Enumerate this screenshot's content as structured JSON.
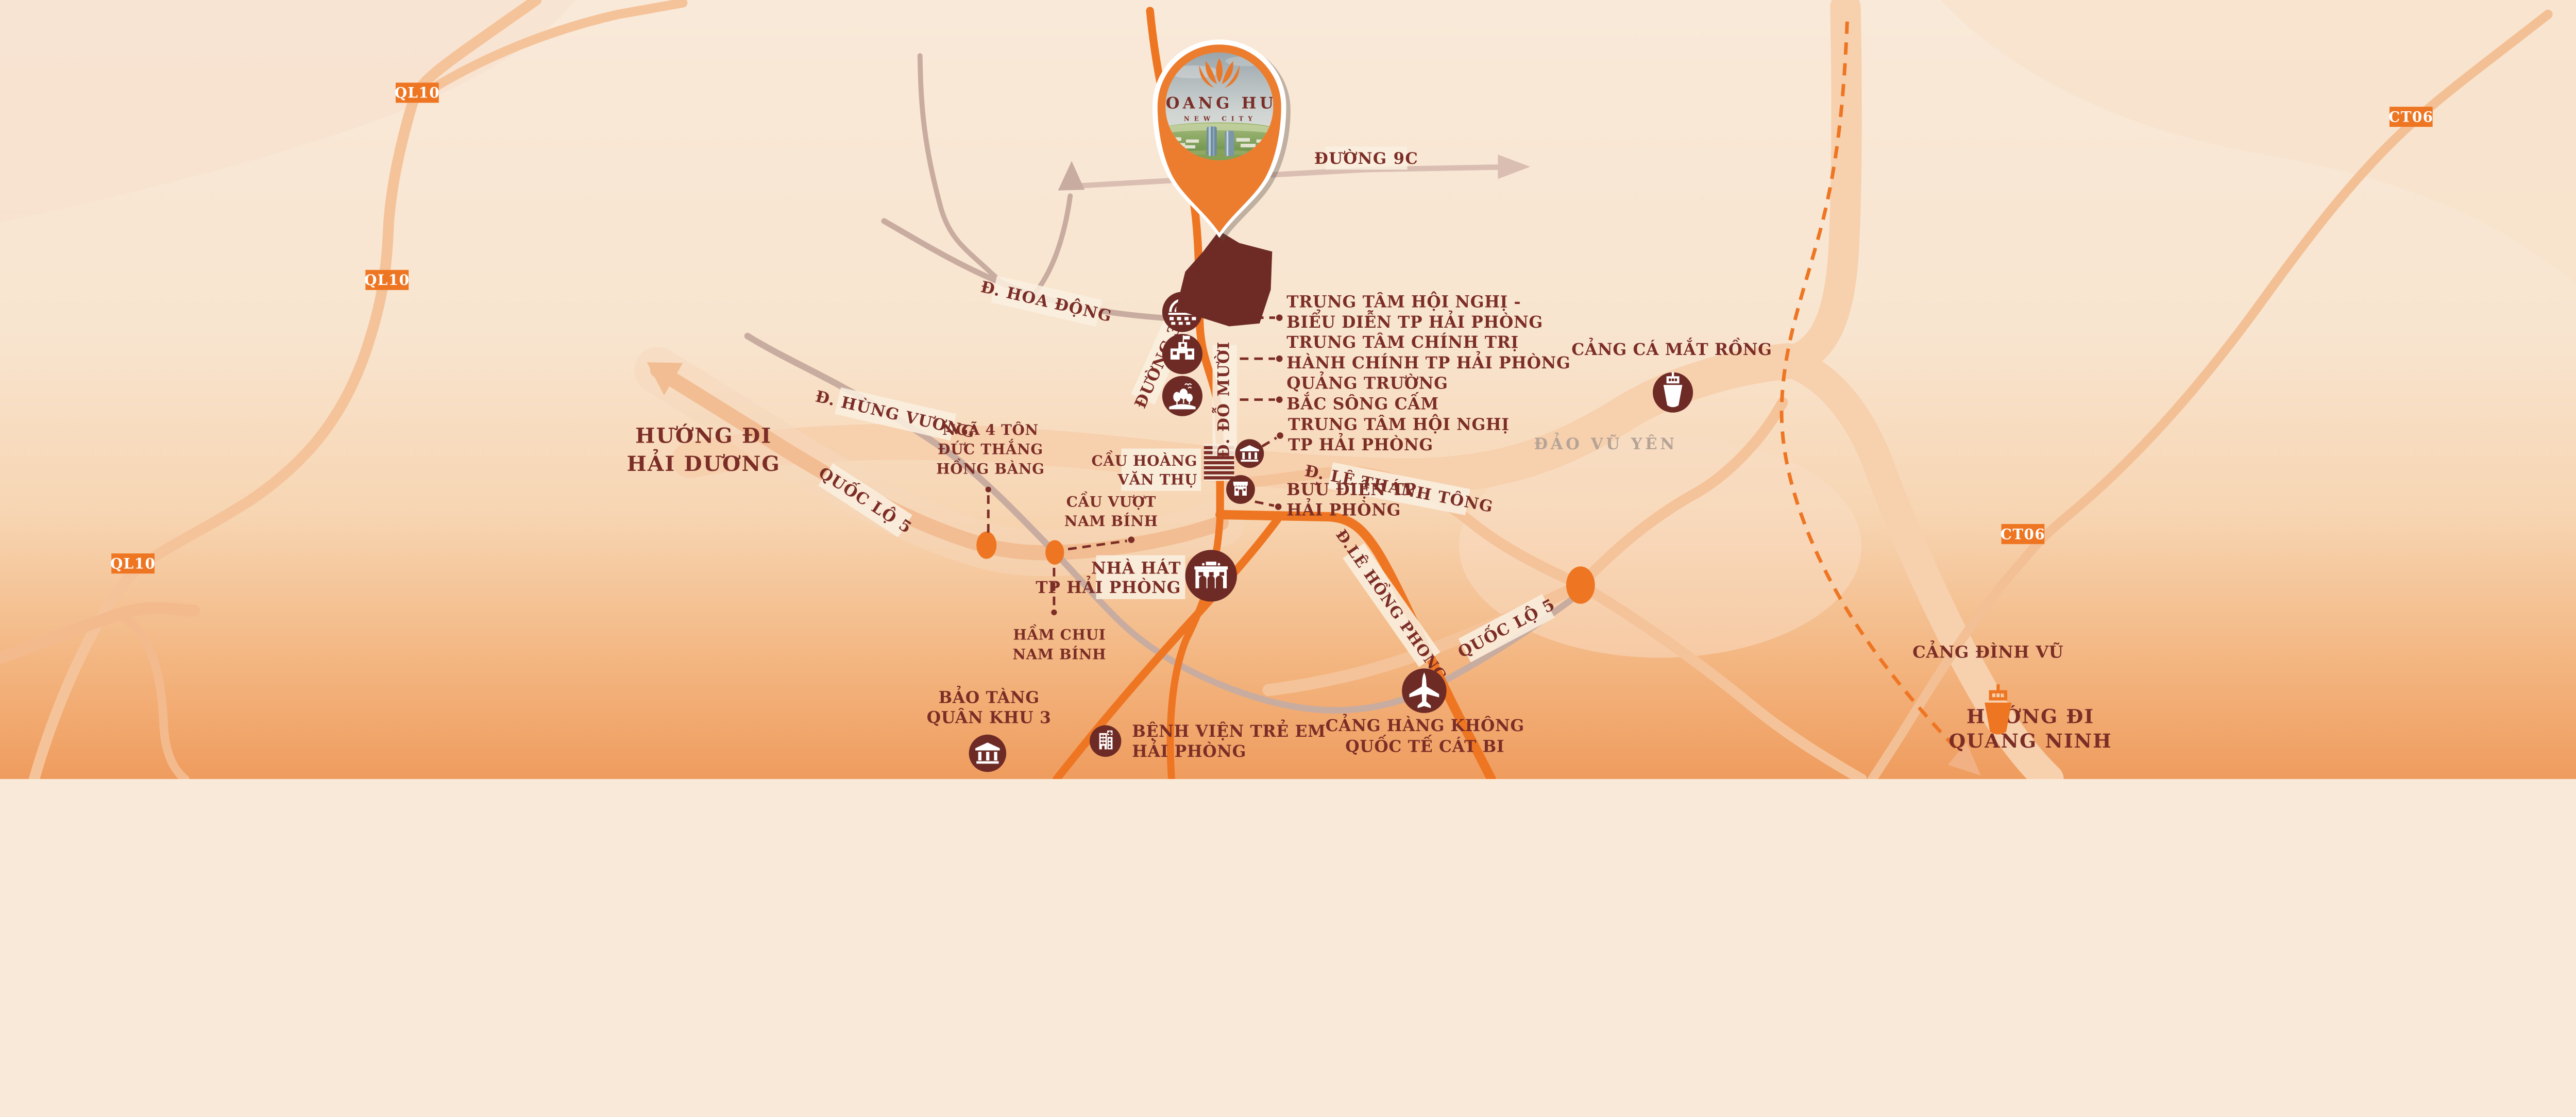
{
  "pin": {
    "brand": "HOANG HUY",
    "sub": "NEW CITY"
  },
  "badges": {
    "ql10": "QL10",
    "ct06": "CT06"
  },
  "road_labels": {
    "duong_9c": "ĐƯỜNG 9C",
    "hoa_dong": "Đ. HOA ĐỘNG",
    "hung_vuong": "Đ. HÙNG VƯƠNG",
    "duong_359": "ĐƯỜNG 359",
    "do_muoi": "Đ. ĐỖ MƯỜI",
    "quoc_lo_5": "QUỐC LỘ 5",
    "le_thanh_tong": "Đ. LÊ THÁNH TÔNG",
    "le_hong_phong": "Đ.LÊ HỒNG PHONG"
  },
  "directions": {
    "hai_duong": {
      "lines": [
        "HƯỚNG ĐI",
        "HẢI DƯƠNG"
      ]
    },
    "quang_ninh": {
      "lines": [
        "HƯỚNG ĐI",
        "QUẢNG NINH"
      ]
    }
  },
  "areas": {
    "vu_yen": "ĐẢO VŨ YÊN"
  },
  "pois": {
    "convention_performance": {
      "lines": [
        "TRUNG TÂM HỘI NGHỊ -",
        "BIỂU DIỄN TP HẢI PHÒNG"
      ]
    },
    "political_admin": {
      "lines": [
        "TRUNG TÂM CHÍNH TRỊ",
        "HÀNH CHÍNH TP HẢI PHÒNG"
      ]
    },
    "bac_song_cam_square": {
      "lines": [
        "QUẢNG TRƯỜNG",
        "BẮC SÔNG CẤM"
      ]
    },
    "convention_center": {
      "lines": [
        "TRUNG TÂM HỘI NGHỊ",
        "TP HẢI PHÒNG"
      ]
    },
    "post_office": {
      "lines": [
        "BƯU ĐIỆN TP",
        "HẢI PHÒNG"
      ]
    },
    "hoang_van_thu_bridge": {
      "lines": [
        "CẦU HOÀNG",
        "VĂN THỤ"
      ]
    },
    "nam_binh_overpass": {
      "lines": [
        "CẦU VƯỢT",
        "NAM BÍNH"
      ]
    },
    "nam_binh_underpass": {
      "lines": [
        "HẦM CHUI",
        "NAM BÍNH"
      ]
    },
    "ton_duc_thang_junction": {
      "lines": [
        "NGÃ 4 TÔN",
        "ĐỨC THẮNG",
        "HỒNG BÀNG"
      ]
    },
    "city_theater": {
      "lines": [
        "NHÀ HÁT",
        "TP HẢI PHÒNG"
      ]
    },
    "military_museum": {
      "lines": [
        "BẢO TÀNG",
        "QUÂN KHU 3"
      ]
    },
    "childrens_hospital": {
      "lines": [
        "BỆNH VIỆN TRẺ EM",
        "HẢI PHÒNG"
      ]
    },
    "cat_bi_airport": {
      "lines": [
        "CẢNG HÀNG KHÔNG",
        "QUỐC TẾ CÁT BI"
      ]
    },
    "mat_rong_fish_port": {
      "lines": [
        "CẢNG CÁ MẮT RỒNG"
      ]
    },
    "dinh_vu_port": {
      "lines": [
        "CẢNG ĐÌNH VŨ"
      ]
    }
  },
  "colors": {
    "brand_orange": "#EE7623",
    "maroon": "#7B2D26",
    "road_light": "#F5C39A",
    "road_gray": "#C9ACA0",
    "background_top": "#F9E9D8",
    "background_bottom": "#EF9C5E",
    "marker_brown": "#6E2B26"
  }
}
